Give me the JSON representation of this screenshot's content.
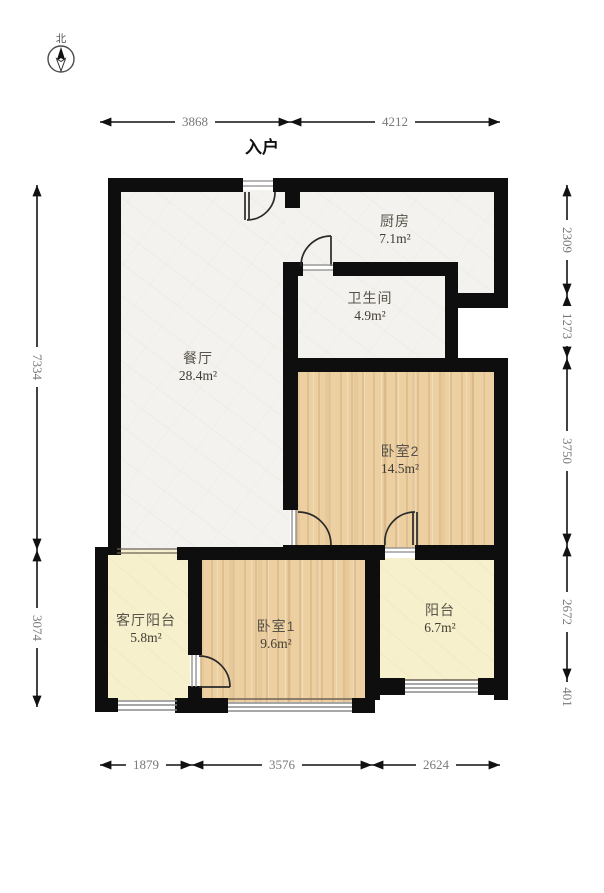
{
  "compass": {
    "label": "北"
  },
  "entrance_label": "入户",
  "rooms": [
    {
      "id": "kitchen",
      "name": "厨房",
      "area": "7.1m²"
    },
    {
      "id": "bathroom",
      "name": "卫生间",
      "area": "4.9m²"
    },
    {
      "id": "dining",
      "name": "餐厅",
      "area": "28.4m²"
    },
    {
      "id": "bedroom2",
      "name": "卧室2",
      "area": "14.5m²"
    },
    {
      "id": "living-balcony",
      "name": "客厅阳台",
      "area": "5.8m²"
    },
    {
      "id": "bedroom1",
      "name": "卧室1",
      "area": "9.6m²"
    },
    {
      "id": "balcony",
      "name": "阳台",
      "area": "6.7m²"
    }
  ],
  "dimensions": {
    "top": [
      "3868",
      "4212"
    ],
    "bottom": [
      "1879",
      "3576",
      "2624"
    ],
    "left": [
      "7334",
      "3074"
    ],
    "right": [
      "2309",
      "1273",
      "3750",
      "2672",
      "401"
    ]
  },
  "colors": {
    "wall": "#0e0e0e",
    "floor_hard": "#f4f2ee",
    "floor_wood": "#ecd0a2",
    "floor_balcony": "#f7f0cc",
    "dimension_text": "#787878",
    "window_line": "#8a8a8a"
  }
}
